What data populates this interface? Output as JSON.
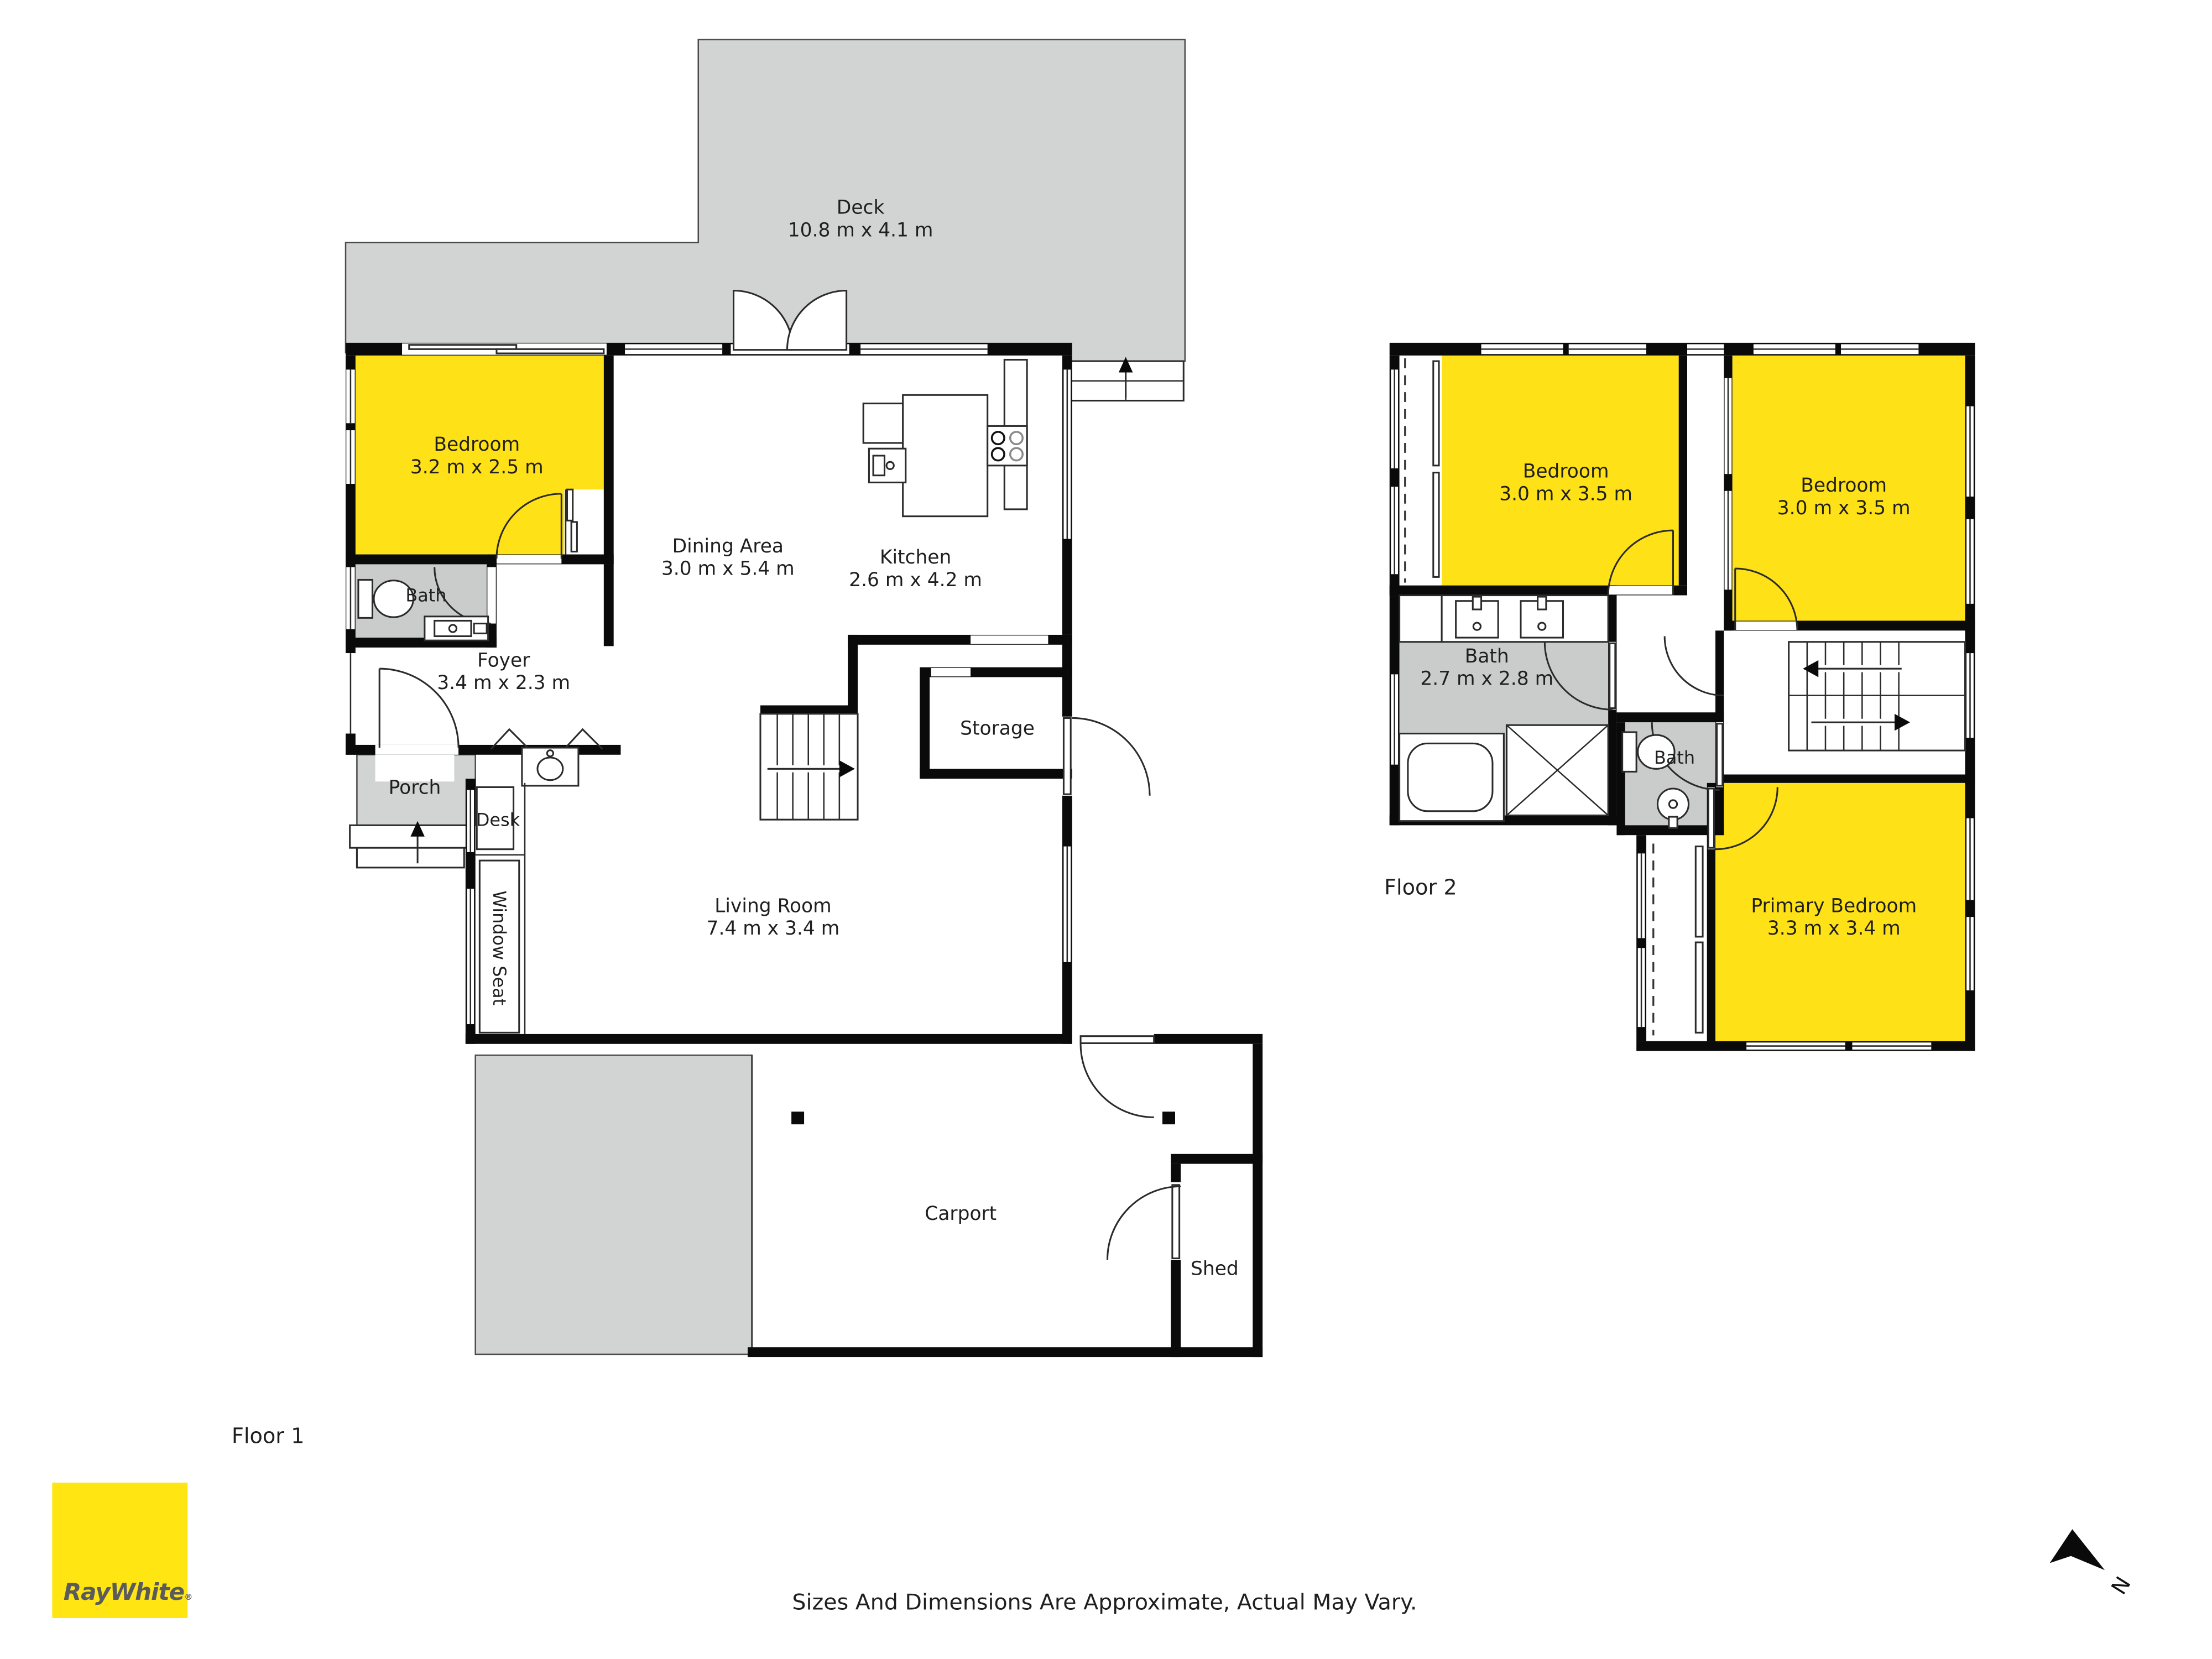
{
  "meta": {
    "floor1_label": "Floor 1",
    "floor2_label": "Floor 2",
    "disclaimer": "Sizes And Dimensions Are Approximate, Actual May Vary."
  },
  "brand": {
    "name": "RayWhite",
    "registered": "®"
  },
  "compass": {
    "north_label": "N"
  },
  "colors": {
    "wall": "#0a0a0a",
    "surface_gray": "#d2d4d3",
    "bath_gray": "#c9cccb",
    "room_yellow": "#ffe117",
    "logo_yellow": "#ffe512",
    "logo_text": "#5a5b5d"
  },
  "floor1": {
    "deck": {
      "name": "Deck",
      "dims": "10.8 m x 4.1 m"
    },
    "bedroom": {
      "name": "Bedroom",
      "dims": "3.2 m x 2.5 m"
    },
    "dining": {
      "name": "Dining Area",
      "dims": "3.0 m x 5.4 m"
    },
    "kitchen": {
      "name": "Kitchen",
      "dims": "2.6 m x 4.2 m"
    },
    "bath": {
      "name": "Bath"
    },
    "foyer": {
      "name": "Foyer",
      "dims": "3.4 m x 2.3 m"
    },
    "porch": {
      "name": "Porch"
    },
    "desk": {
      "name": "Desk"
    },
    "window_seat": {
      "name": "Window Seat"
    },
    "living": {
      "name": "Living Room",
      "dims": "7.4 m x 3.4 m"
    },
    "storage": {
      "name": "Storage"
    },
    "carport": {
      "name": "Carport"
    },
    "shed": {
      "name": "Shed"
    }
  },
  "floor2": {
    "bedroom_left": {
      "name": "Bedroom",
      "dims": "3.0 m x 3.5 m"
    },
    "bedroom_right": {
      "name": "Bedroom",
      "dims": "3.0 m x 3.5 m"
    },
    "bath_main": {
      "name": "Bath",
      "dims": "2.7 m x 2.8 m"
    },
    "bath_ensuite": {
      "name": "Bath"
    },
    "primary": {
      "name": "Primary Bedroom",
      "dims": "3.3 m x 3.4 m"
    }
  }
}
